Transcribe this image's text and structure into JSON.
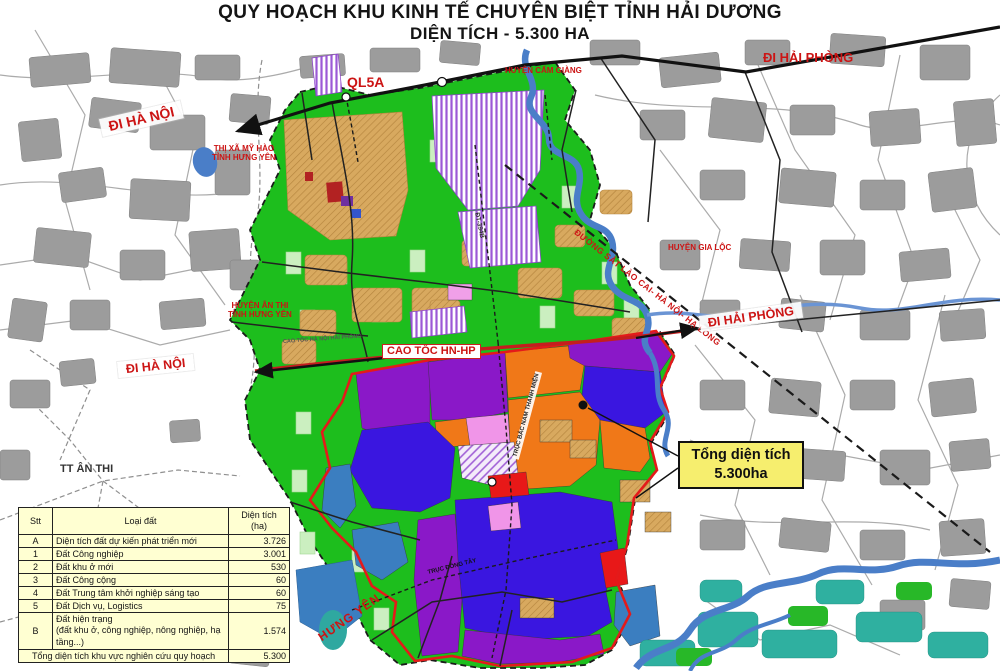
{
  "title": {
    "line1": "QUY HOẠCH KHU KINH TẾ CHUYÊN BIỆT TỈNH HẢI DƯƠNG",
    "line2": "DIỆN TÍCH - 5.300 HA"
  },
  "labels": {
    "di_ha_noi_top": "ĐI HÀ NỘI",
    "di_hai_phong_top": "ĐI HẢI PHÒNG",
    "ql5a": "QL5A",
    "huyen_cam_giang": "HUYỆN CẨM GIÀNG",
    "thi_xa_my_hao": "THỊ XÃ MỸ HÀO\nTỈNH HƯNG YÊN",
    "huyen_an_thi": "HUYỆN ÂN THI\nTỈNH HƯNG YÊN",
    "duong_sat": "ĐƯỜNG SẮT LÀO CAI- HÀ NỘI- HẠ LONG",
    "huyen_gia_loc": "HUYỆN GIA LỘC",
    "di_hai_phong_mid": "ĐI HẢI PHÒNG",
    "cao_toc": "CAO TỐC HN-HP",
    "cao_toc_tiny": "CAO TỐC HÀ NỘI HẢI PHÒNG",
    "di_ha_noi_mid": "ĐI HÀ NỘI",
    "tt_an_thi": "TT ÂN THI",
    "hung_yen": "HƯNG YÊN",
    "dt_394b": "ĐT-394B",
    "truc_bac_nam": "TRỤC BẮC NAM THANH MIỆN",
    "truc_dong_tay": "TRỤC ĐÔNG TÂY"
  },
  "callout": {
    "line1": "Tổng diện tích",
    "line2": "5.300ha"
  },
  "table": {
    "headers": {
      "stt": "Stt",
      "loai": "Loại đất",
      "dt": "Diện tích\n(ha)"
    },
    "rows": [
      {
        "stt": "A",
        "loai": "Diện tích đất dự kiến phát triển mới",
        "dt": "3.726"
      },
      {
        "stt": "1",
        "loai": "Đất Công nghiệp",
        "dt": "3.001"
      },
      {
        "stt": "2",
        "loai": "Đất khu ở mới",
        "dt": "530"
      },
      {
        "stt": "3",
        "loai": "Đất Công cộng",
        "dt": "60"
      },
      {
        "stt": "4",
        "loai": "Đất Trung tâm khởi nghiệp sáng tạo",
        "dt": "60"
      },
      {
        "stt": "5",
        "loai": "Đất Dịch vụ, Logistics",
        "dt": "75"
      },
      {
        "stt": "B",
        "loai": "Đất hiện trạng\n(đất khu ở, công nghiệp, nông nghiệp, hạ tầng...)",
        "dt": "1.574"
      }
    ],
    "footer": {
      "label": "Tổng diện tích khu vực nghiên cứu quy hoạch",
      "value": "5.300"
    }
  },
  "colors": {
    "study_green": "#1dbe1d",
    "pale_green_block": "#cbefc0",
    "village_tan": "#d8a95f",
    "industrial_purple": "#8a18c8",
    "industrial_blueviolet": "#3a16e0",
    "service_orange": "#f07818",
    "red_zone": "#e81818",
    "pink_zone": "#f095e8",
    "water_blue": "#4a7ec8",
    "steel_blue": "#3b7ec0",
    "teal": "#2fb0a0",
    "settlement_gray": "#9c9c9c",
    "boundary_red": "#e41a1a",
    "expressway_red": "#c41e1e",
    "label_red": "#cc1414",
    "table_bg": "#ffffd2",
    "callout_bg": "#f6ee6e"
  }
}
